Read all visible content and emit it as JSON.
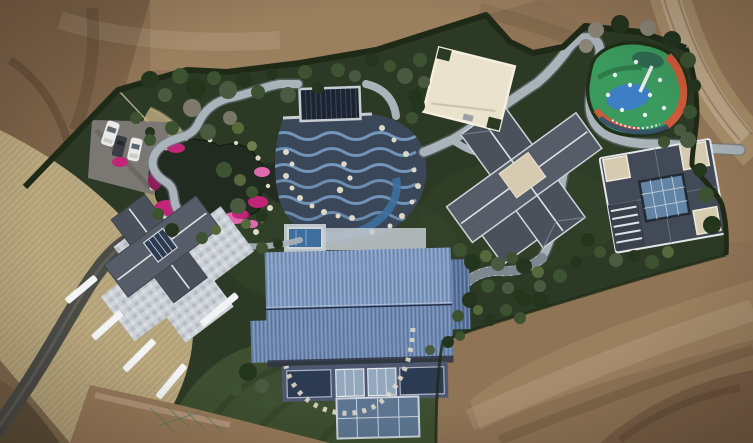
{
  "scene": {
    "title": "Aerial drone view of a landscaped villa estate surrounded by bare earth",
    "description": "Top-down aerial photograph of a private estate: a dark-green landscaped garden with an ornamental pond ringed by magenta azaleas, a wave-patterned pool terrace with a covered lap pool, winding grey paths, a colorful children's playground, a cream flat-roofed pavilion, two grey-roofed villas, a grey-roofed house with a large stone plaza, and a big blue metal-roofed hall; brown graded dirt surrounds the property with a dirt track at top right, an asphalt drive at lower left and three cars in a small parking lot.",
    "features": {
      "terrain": "graded brown earth surrounding the estate",
      "dirt_road": "dirt track curving along the top right",
      "garden": "dark landscaped garden enclosed by a clipped hedge",
      "pale_grass": "band of pale dry grass along the west side",
      "driveway": "asphalt driveway entering from the bottom left",
      "parking": "small parking area with three parked cars",
      "plaza": "large light stone mosaic plaza crossing the west house",
      "left_building": "west house with grey gabled roofs and glass atrium",
      "pond": "ornamental pond edged with white stones and magenta azaleas",
      "pool_area": "wave-patterned pool terrace with covered navy lap pool and small blue plunge pool",
      "paths": "light grey winding garden paths and stone stair path",
      "main_building": "large hall with ribbed blue metal roof and glass atrium facade",
      "middle_villa": "central villa with dark grey cross-shaped hip roof",
      "right_villa": "east villa with dark roof, beige flat corners and glass courtyard",
      "pavilion": "cream flat-roofed pavilion",
      "playground": "oval playground painted green, blue and orange with white play equipment",
      "vegetation": "clipped shrubs, trees and bare winter trees",
      "lawn": "mown green lawn below the blue-roofed hall",
      "cars": "two white cars and one dark car parked on grey asphalt"
    }
  },
  "palette": {
    "dirt_base": "#8f7456",
    "dirt_light": "#a58a68",
    "dirt_dark": "#6f5841",
    "dirt_tl": "#7c6248",
    "dirt_road": "#a98f6b",
    "dirt_warm": "#97795a",
    "grass_pale": "#b4a278",
    "grass_pale2": "#c9b88d",
    "garden_dark": "#2c3a25",
    "garden_mid": "#36462c",
    "lawn": "#3d4f30",
    "hedge": "#1e2a16",
    "bush_dark": "#24351e",
    "bush_mid": "#3c5230",
    "bush_light": "#55693c",
    "bush_pale": "#6d7f4e",
    "tree_gray": "#4a5a40",
    "tree_bare": "#8c8678",
    "path_gray": "#aab3ba",
    "path_light": "#c6cdd3",
    "path_dark": "#6b7680",
    "road_asphalt": "#4c4c47",
    "parking": "#7b7873",
    "plaza": "#c9cfd5",
    "plaza_dark": "#8f9aa2",
    "pond": "#222b1f",
    "water_blue": "#3e6f9e",
    "pool_deck": "#3a4759",
    "pool_wave": "#7ca6cd",
    "pool_cover": "#1c2431",
    "pool_frame": "#c8cdd2",
    "azalea": "#c12578",
    "azalea_light": "#e06aae",
    "azalea_deep": "#8f1d5a",
    "stone_white": "#ded8c6",
    "roof_blue_light": "#7e99c1",
    "roof_blue_dark": "#6b86b0",
    "roof_blue_shade": "#55719c",
    "facade_dark": "#2e3442",
    "wall_blue": "#4d5870",
    "glass_dark": "#2c3a52",
    "glass_light": "#93a8bd",
    "atrium_glass": "#5d7590",
    "roof_gray": "#565d68",
    "roof_gray2": "#4a515b",
    "roof_gray_dark": "#434a57",
    "roof_ridge": "#dfe3e6",
    "roof_beige": "#d6cbb0",
    "pavilion": "#eae2cc",
    "courtyard_glass": "#6285a6",
    "play_green": "#3b9a5e",
    "play_blue": "#3d7ec4",
    "play_orange": "#cd5a3b",
    "play_teal": "#2e6a52",
    "play_navy": "#33506a",
    "play_white": "#e9edf0",
    "play_border": "#203018",
    "car_white": "#e9e9e7",
    "car_dark": "#3a3d41",
    "car_glass": "#5a6670",
    "mesh_green": "#49795a",
    "fence": "#cdc3a4"
  }
}
